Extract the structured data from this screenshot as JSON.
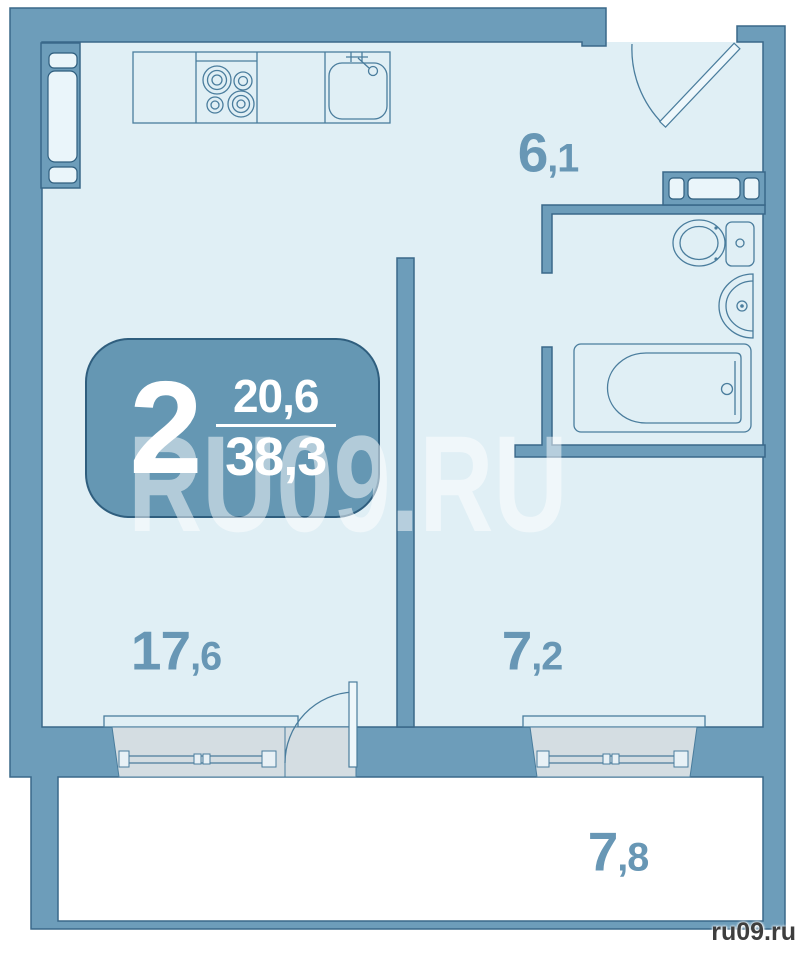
{
  "plan": {
    "title_badge": {
      "rooms_count": "2",
      "living_area": "20,6",
      "total_area": "38,3"
    },
    "rooms": [
      {
        "id": "hallway",
        "area": "6,1"
      },
      {
        "id": "living-room",
        "area": "17,6"
      },
      {
        "id": "bedroom",
        "area": "7,2"
      },
      {
        "id": "balcony",
        "area": "7,8"
      }
    ],
    "watermark": "RU09.RU",
    "site_credit": "ru09.ru",
    "colors": {
      "wall": "#6d9dba",
      "wall_outline": "#3a6889",
      "interior": "#e0eff5",
      "fixture_line": "#4a7d9d",
      "window_fill": "#d4dde2",
      "label": "#6897b5",
      "badge_fill": "#6597b3",
      "badge_text": "#ffffff",
      "balcony_fill": "#ffffff",
      "credit_text": "#3e3e3e"
    }
  }
}
